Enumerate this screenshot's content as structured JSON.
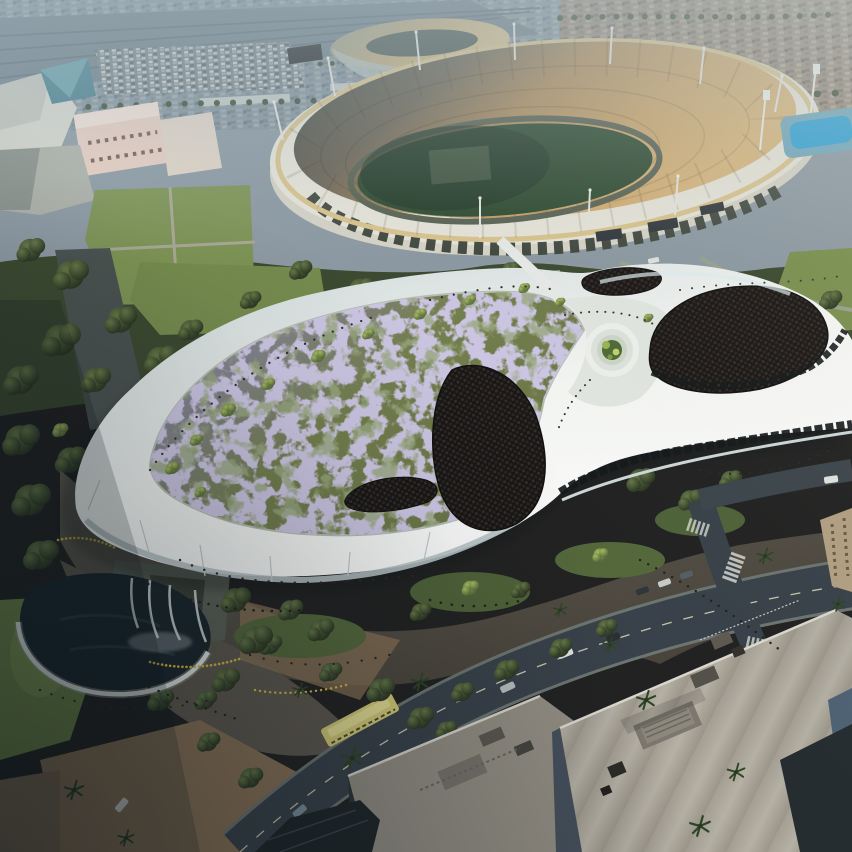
{
  "scene": {
    "type": "aerial-architectural-rendering",
    "description_labels": {
      "main_building": "futuristic-curved-museum-with-flower-meadow-roof",
      "stadium": "oval-coliseum-stadium",
      "second_stadium": "gold-roof-stadium",
      "science_center": "pink-buildings-with-glass-pyramid",
      "pool": "swim-stadium-pool",
      "water_feature": "waterfall-pond",
      "transit": "yellow-bus-on-boulevard",
      "foreground": "city-rooftops-and-streets"
    }
  },
  "colors": {
    "sky_base": "#8d9aa3",
    "rails": "#67767f",
    "city_warm_base": "#97897b",
    "gold_roof": "#c3ab7c",
    "gold_inner": "#4d5a52",
    "stadium_wall": "#eae7db",
    "stadium_wall_low": "#d8d5c8",
    "stadium_band": "#dbc58e",
    "bowl_shadow": "#3c423c",
    "bowl_mid": "#b08c5a",
    "bowl_lit": "#dbb77b",
    "field_green": "#2a472c",
    "track": "#57604f",
    "pool_blue": "#2ba2d8",
    "tree_band": "#3c4a31",
    "lawn": "#7e9454",
    "lawn_bright": "#85a058",
    "museum_rim_shade": "#cdd8da",
    "museum_mid": "#f6f8f5",
    "museum_bright": "#ffffff",
    "meadow_purple_edge": "#8e86ba",
    "meadow_olive": "#75804e",
    "meadow_green_deep": "#697446",
    "panel_dark": "#191615",
    "panel_dot": "#332d2a",
    "plaza_light": "#645e54",
    "plaza_dark": "#474239",
    "road": "#39424a",
    "dirt": "#8c7457",
    "pond": "#1b262d",
    "water_white": "#e3e9e8",
    "roof_big": "#a49e93",
    "roof_mid": "#948f84",
    "bus_yellow": "#d6cd76",
    "science_pink": "#ead0c2",
    "pyramid_teal": "#49808f",
    "building_blue_wall": "#46505c",
    "tan_building": "#b3a183"
  },
  "regions": [
    {
      "name": "city-background",
      "label": "hazy city skyline and rail yards"
    },
    {
      "name": "gold-stadium",
      "label": "gold roof stadium in distance"
    },
    {
      "name": "coliseum-stadium",
      "label": "oval stadium with tan seating bowl"
    },
    {
      "name": "science-center",
      "label": "pink museum buildings with teal glass pyramid"
    },
    {
      "name": "swim-pool",
      "label": "bright blue outdoor pool"
    },
    {
      "name": "park-band",
      "label": "tree-filled park with lawns and paths"
    },
    {
      "name": "museum-building",
      "label": "white organic museum with purple meadow roof and dark panel lobes"
    },
    {
      "name": "oculus-garden",
      "label": "circular terraced roof garden"
    },
    {
      "name": "waterfall-pond",
      "label": "dark pond with white waterfall cascades"
    },
    {
      "name": "plaza",
      "label": "pedestrian plaza with crowds and planters"
    },
    {
      "name": "boulevard",
      "label": "diagonal street with yellow bus and cars"
    },
    {
      "name": "downtown-rooftops",
      "label": "large gray rooftops with equipment"
    },
    {
      "name": "palm-trees",
      "label": "street palm trees"
    },
    {
      "name": "crowds",
      "label": "scattered pedestrians"
    }
  ]
}
